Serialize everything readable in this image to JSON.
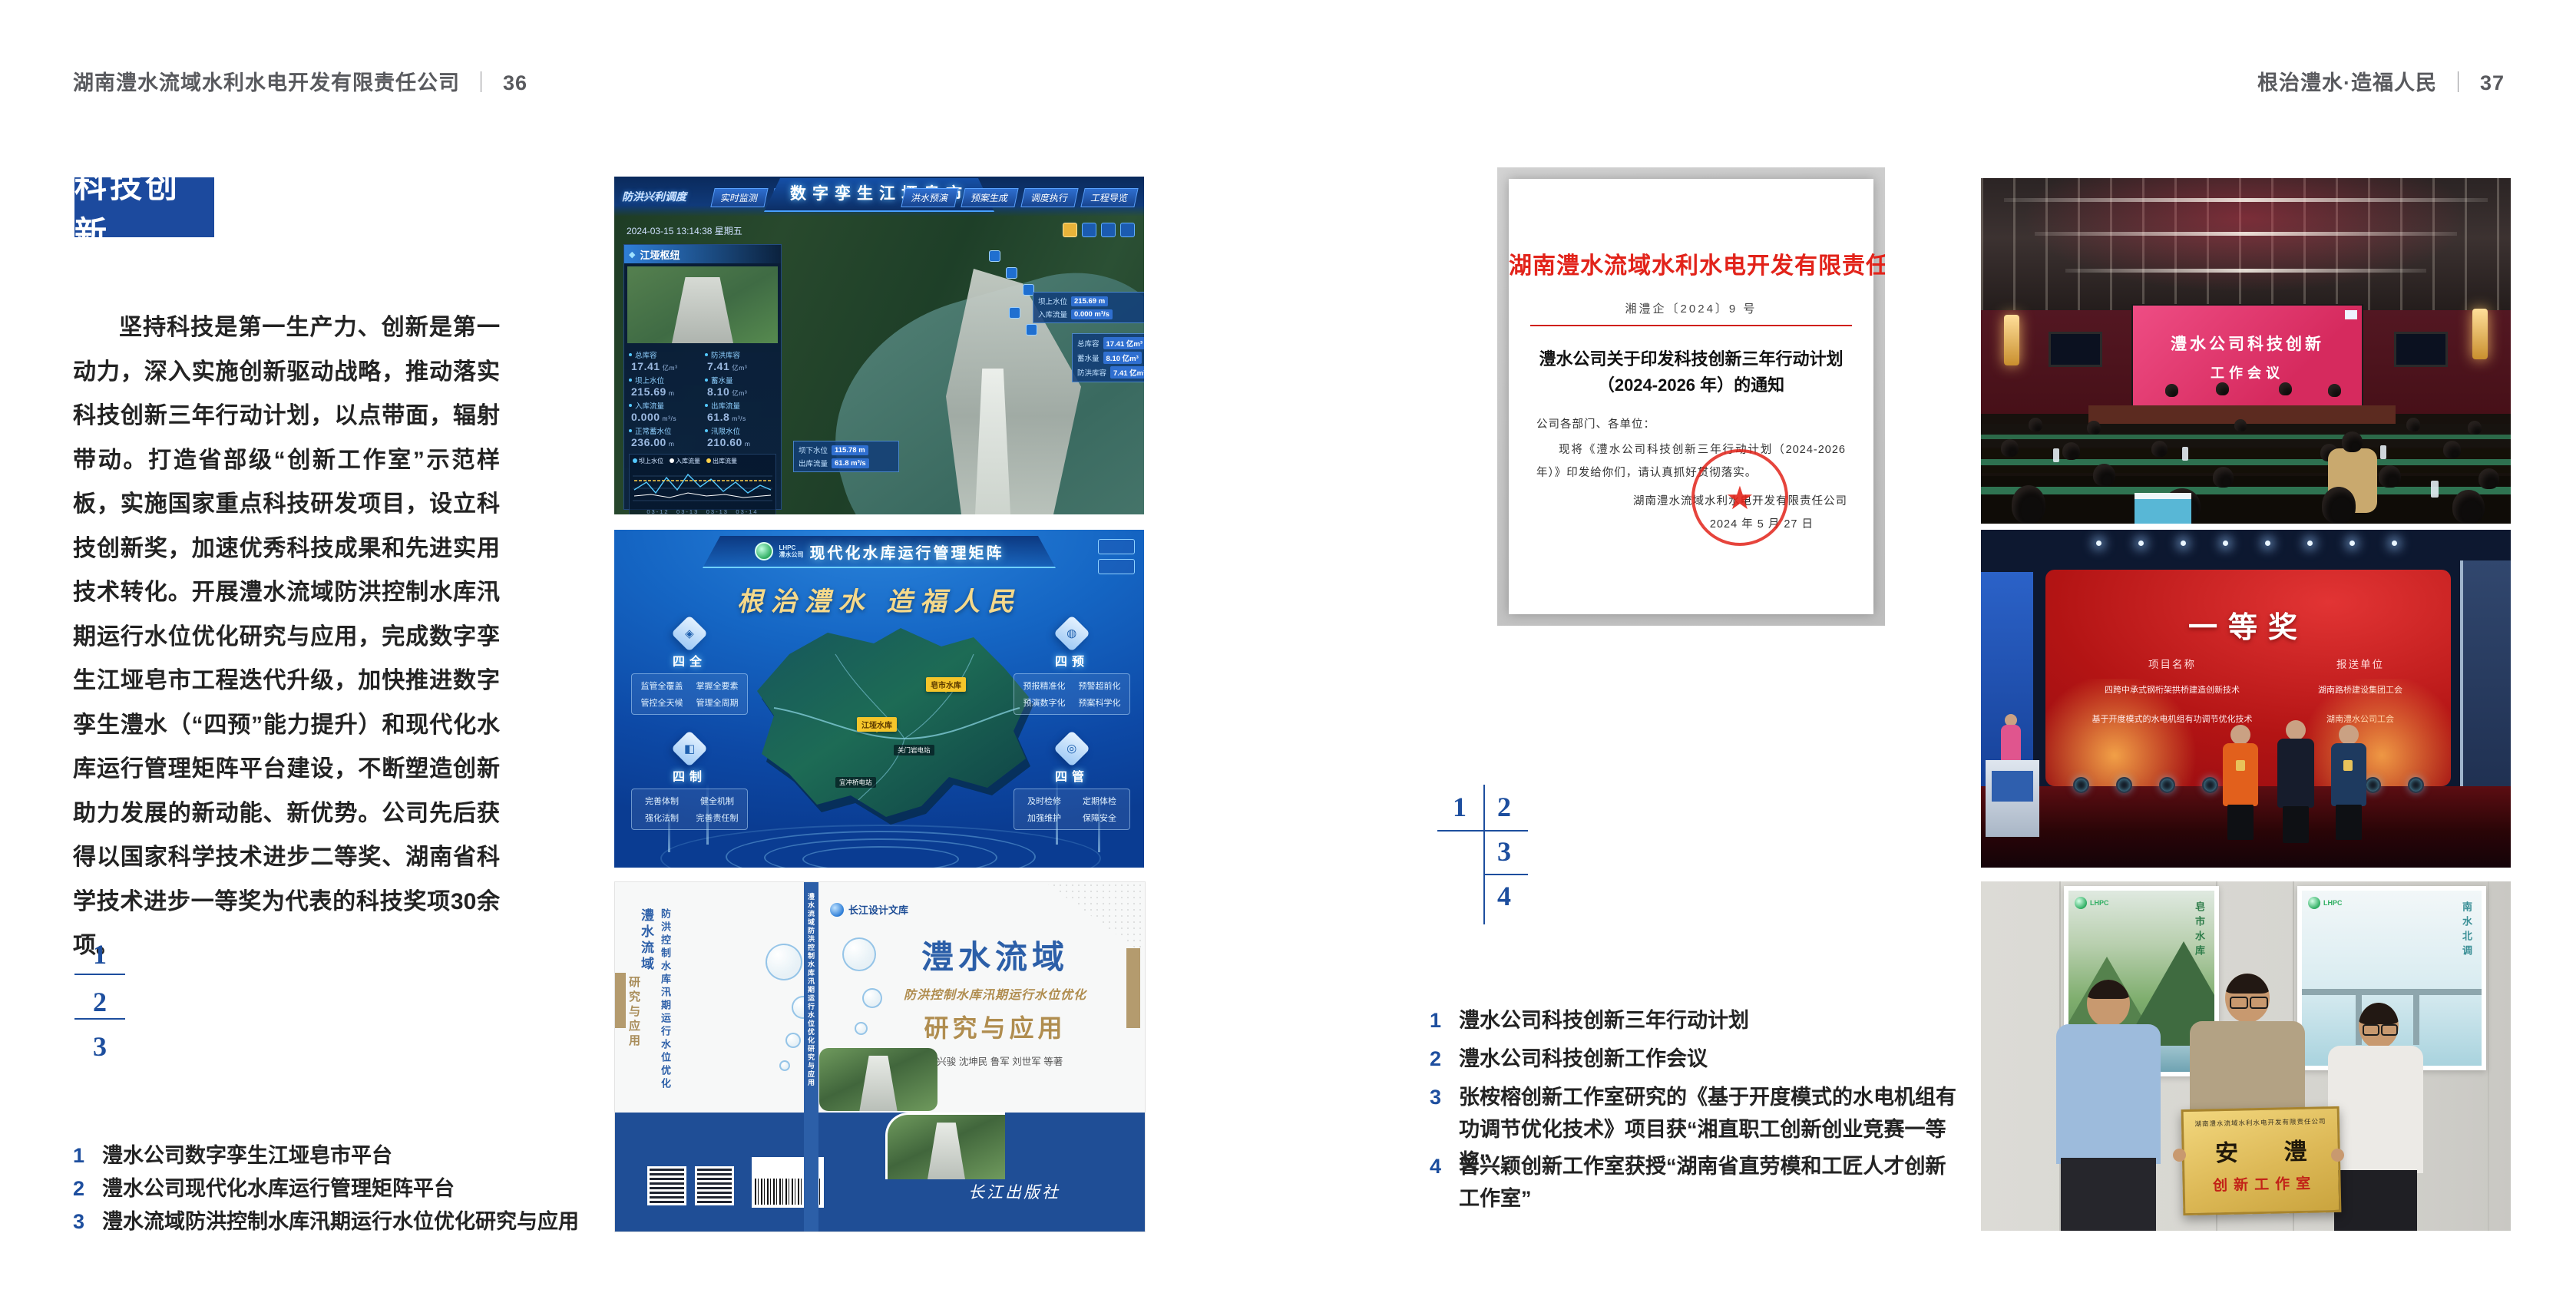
{
  "colors": {
    "accent_blue": "#1d4e9e",
    "badge_blue": "#1c4a9e",
    "doc_red": "#e2231a"
  },
  "page_left": {
    "header": {
      "company": "湖南澧水流域水利水电开发有限责任公司",
      "sep": "｜",
      "page_no": "36"
    },
    "badge": "科技创新",
    "paragraph": "坚持科技是第一生产力、创新是第一动力，深入实施创新驱动战略，推动落实科技创新三年行动计划，以点带面，辐射带动。打造省部级“创新工作室”示范样板，实施国家重点科技研发项目，设立科技创新奖，加速优秀科技成果和先进实用技术转化。开展澧水流域防洪控制水库汛期运行水位优化研究与应用，完成数字孪生江垭皂市工程迭代升级，加快推进数字孪生澧水（“四预”能力提升）和现代化水库运行管理矩阵平台建设，不断塑造创新助力发展的新动能、新优势。公司先后获得以国家科学技术进步二等奖、湖南省科学技术进步一等奖为代表的科技奖项30余项。",
    "fig_index": [
      "1",
      "2",
      "3"
    ],
    "captions": [
      {
        "no": "1",
        "text": "澧水公司数字孪生江垭皂市平台"
      },
      {
        "no": "2",
        "text": "澧水公司现代化水库运行管理矩阵平台"
      },
      {
        "no": "3",
        "text": "澧水流域防洪控制水库汛期运行水位优化研究与应用"
      }
    ]
  },
  "page_right": {
    "header": {
      "motto": "根治澧水·造福人民",
      "sep": "｜",
      "page_no": "37"
    },
    "fig_index": [
      "1",
      "2",
      "3",
      "4"
    ],
    "captions": [
      {
        "no": "1",
        "text": "澧水公司科技创新三年行动计划"
      },
      {
        "no": "2",
        "text": "澧水公司科技创新工作会议"
      },
      {
        "no": "3",
        "text": "张桉榕创新工作室研究的《基于开度模式的水电机组有功调节优化技术》项目获“湘直职工创新创业竞赛一等奖”"
      },
      {
        "no": "4",
        "text": "曾兴颖创新工作室获授“湖南省直劳模和工匠人才创新工作室”"
      }
    ]
  },
  "fig_dashboard": {
    "module_label": "防洪兴利调度",
    "tabs_left": [
      "实时监测",
      "洪水预报",
      "防洪预警"
    ],
    "title": "数字孪生江垭皂市",
    "tabs_right": [
      "洪水预演",
      "预案生成",
      "调度执行",
      "工程导览"
    ],
    "datetime": "2024-03-15 13:14:38 星期五",
    "hub_panel_title": "江垭枢纽",
    "stats": [
      {
        "label": "总库容",
        "value": "17.41",
        "unit": "亿m³"
      },
      {
        "label": "防洪库容",
        "value": "7.41",
        "unit": "亿m³"
      },
      {
        "label": "坝上水位",
        "value": "215.69",
        "unit": "m"
      },
      {
        "label": "蓄水量",
        "value": "8.10",
        "unit": "亿m³"
      },
      {
        "label": "入库流量",
        "value": "0.000",
        "unit": "m³/s"
      },
      {
        "label": "出库流量",
        "value": "61.8",
        "unit": "m³/s"
      },
      {
        "label": "正常蓄水位",
        "value": "236.00",
        "unit": "m"
      },
      {
        "label": "汛限水位",
        "value": "210.60",
        "unit": "m"
      }
    ],
    "chart_legend": [
      "坝上水位",
      "入库流量",
      "出库流量"
    ],
    "chart_xticks": "03-12　03-13　03-13　03-14",
    "power_panel_title": "江垭发电",
    "power_stats": [
      {
        "label": "年发电计划",
        "value": "6.3000",
        "unit": "亿度"
      },
      {
        "label": "年累计发电量",
        "value": "2907",
        "unit": "万度"
      },
      {
        "label": "月累计发电量",
        "value": "3259.21",
        "unit": "万度"
      },
      {
        "label": "当前出力",
        "value": "0.00",
        "unit": "MW"
      },
      {
        "label": "发电流量",
        "value": "0.00",
        "unit": "m³/s"
      },
      {
        "label": "弃水流量",
        "value": "0.00",
        "unit": "m³/s"
      }
    ],
    "tooltip_upstream": [
      {
        "label": "坝上水位",
        "value": "215.69 m"
      },
      {
        "label": "入库流量",
        "value": "0.000 m³/s"
      }
    ],
    "tooltip_storage": [
      {
        "label": "总库容",
        "value": "17.41 亿m³"
      },
      {
        "label": "蓄水量",
        "value": "8.10 亿m³"
      },
      {
        "label": "防洪库容",
        "value": "7.41 亿m³"
      }
    ],
    "tooltip_downstream": [
      {
        "label": "坝下水位",
        "value": "115.78 m"
      },
      {
        "label": "出库流量",
        "value": "61.8 m³/s"
      }
    ]
  },
  "fig_matrix": {
    "logo_abbr": "LHPC",
    "logo_name": "澧水公司",
    "title": "现代化水库运行管理矩阵",
    "slogan": "根治澧水 造福人民",
    "panels": [
      {
        "name": "四全",
        "items": [
          "监管全覆盖",
          "掌握全要素",
          "管控全天候",
          "管理全周期"
        ]
      },
      {
        "name": "四预",
        "items": [
          "预报精准化",
          "预警超前化",
          "预演数字化",
          "预案科学化"
        ]
      },
      {
        "name": "四制",
        "items": [
          "完善体制",
          "健全机制",
          "强化法制",
          "完善责任制"
        ]
      },
      {
        "name": "四管",
        "items": [
          "及时检修",
          "定期体检",
          "加强维护",
          "保障安全"
        ]
      }
    ],
    "markers_major": [
      "皂市水库",
      "江垭水库"
    ],
    "markers_minor": [
      "关门岩电站",
      "宜冲桥电站"
    ]
  },
  "fig_book": {
    "series": "长江设计文库",
    "title_main": "澧水流域",
    "title_sub": "防洪控制水库汛期运行水位优化",
    "title_tail": "研究与应用",
    "authors": "洪兴骏 沈坤民 鲁军 刘世军 等著",
    "publisher": "长江出版社",
    "spine": "澧水流域防洪控制水库汛期运行水位优化研究与应用"
  },
  "fig_document": {
    "masthead": "湖南澧水流域水利水电开发有限责任公司文件",
    "doc_no": "湘澧企〔2024〕9 号",
    "title_line1": "澧水公司关于印发科技创新三年行动计划",
    "title_line2": "（2024-2026 年）的通知",
    "salutation": "公司各部门、各单位：",
    "body": "现将《澧水公司科技创新三年行动计划（2024-2026 年）》印发给你们，请认真抓好贯彻落实。",
    "signer": "湖南澧水流域水利水电开发有限责任公司",
    "date": "2024 年 5 月 27 日",
    "stamp_star": "★"
  },
  "fig_meeting": {
    "screen_title_line1": "澧水公司科技创新",
    "screen_title_line2": "工作会议"
  },
  "fig_award": {
    "heading": "一等奖",
    "col_project": "项目名称",
    "col_unit": "报送单位",
    "rows": [
      {
        "project": "四跨中承式钢桁架拱桥建造创新技术",
        "unit": "湖南路桥建设集团工会"
      },
      {
        "project": "基于开度模式的水电机组有功调节优化技术",
        "unit": "湖南澧水公司工会"
      }
    ]
  },
  "fig_group": {
    "poster_left_logo": "LHPC",
    "poster_left_text": "皂市水库",
    "poster_right_logo": "LHPC",
    "poster_right_text": "南水北调",
    "plaque_org": "湖南澧水流域水利水电开发有限责任公司",
    "plaque_name": "安 澧",
    "plaque_sub": "创新工作室"
  }
}
